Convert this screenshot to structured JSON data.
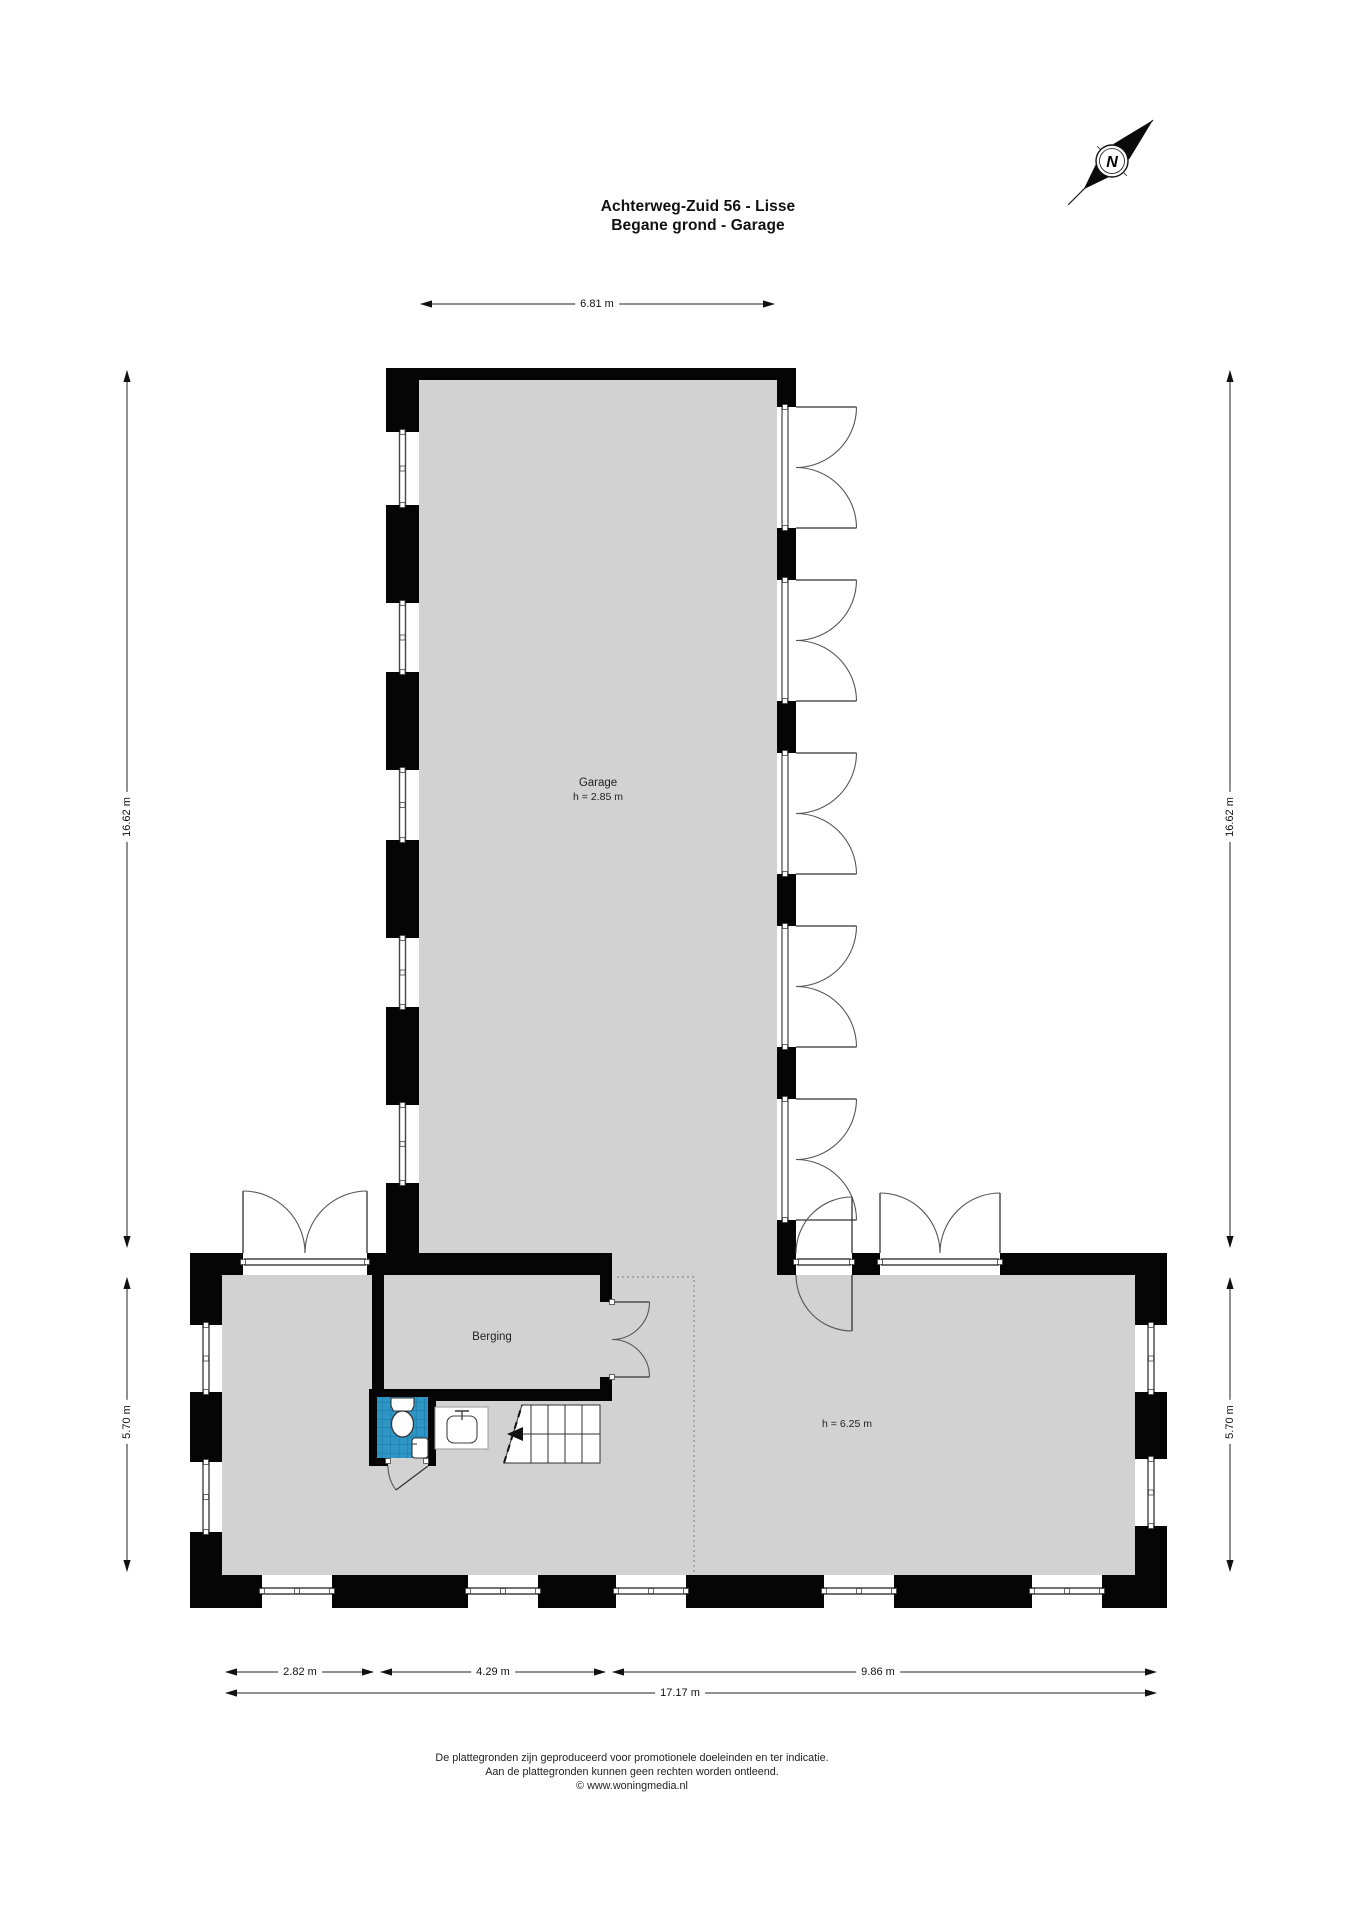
{
  "title": {
    "line1": "Achterweg-Zuid 56 - Lisse",
    "line2": "Begane grond - Garage"
  },
  "compass": {
    "label": "N"
  },
  "rooms": {
    "garage": {
      "name": "Garage",
      "height": "h = 2.85 m"
    },
    "berging": {
      "name": "Berging"
    },
    "hall": {
      "height": "h = 6.25 m"
    }
  },
  "dimensions": {
    "top": "6.81 m",
    "left_upper": "16.62 m",
    "left_lower": "5.70 m",
    "right_upper": "16.62 m",
    "right_lower": "5.70 m",
    "bottom": [
      "2.82 m",
      "4.29 m",
      "9.86 m"
    ],
    "total": "17.17 m"
  },
  "footer": {
    "line1": "De plattegronden zijn geproduceerd voor promotionele doeleinden en ter indicatie.",
    "line2": "Aan de plattegronden kunnen geen rechten worden ontleend.",
    "line3": "© www.woningmedia.nl"
  },
  "colors": {
    "wall": "#000000",
    "floor": "#d2d2d2",
    "tile_blue": "#2e95c5",
    "tile_grout": "#1b7dab",
    "dimension_line": "#222222"
  }
}
